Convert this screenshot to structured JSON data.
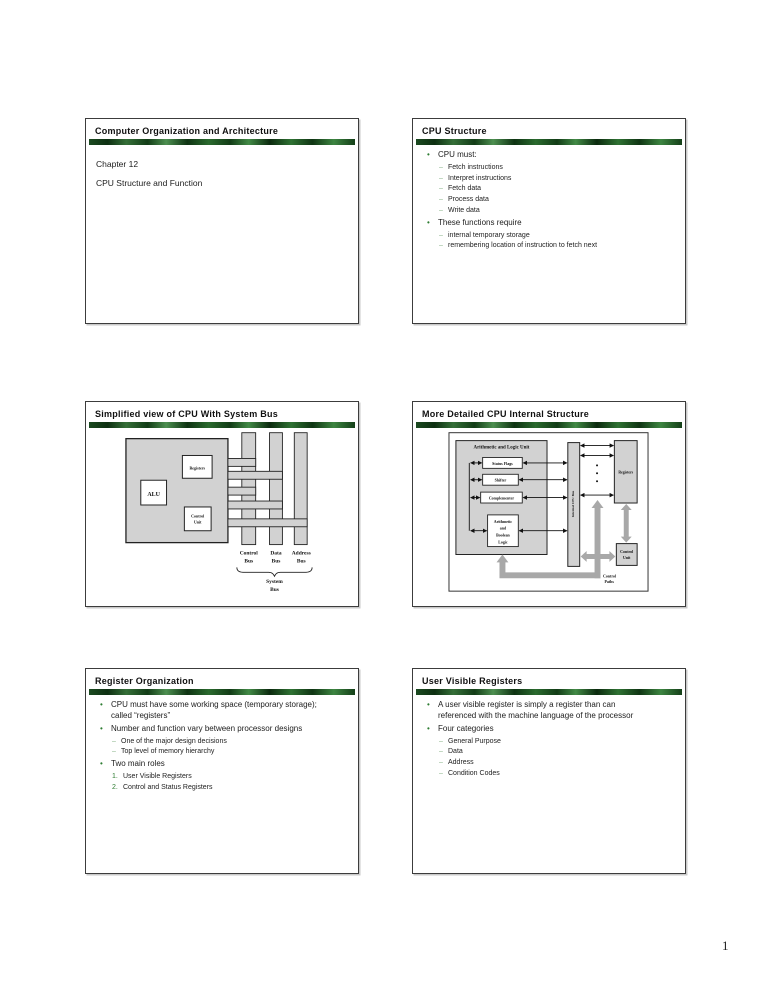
{
  "page_number": "1",
  "slides": [
    {
      "title": "Computer Organization and Architecture",
      "lines": [
        "Chapter 12",
        "CPU Structure and Function"
      ]
    },
    {
      "title": "CPU Structure",
      "items": [
        {
          "marker": "•",
          "text": "CPU must:"
        },
        {
          "marker": "–",
          "text": "Fetch instructions"
        },
        {
          "marker": "–",
          "text": "Interpret instructions"
        },
        {
          "marker": "–",
          "text": "Fetch data"
        },
        {
          "marker": "–",
          "text": "Process data"
        },
        {
          "marker": "–",
          "text": "Write data"
        },
        {
          "marker": "•",
          "text": "These functions require"
        },
        {
          "marker": "–",
          "text": "internal temporary storage"
        },
        {
          "marker": "–",
          "text": "remembering location of instruction to fetch next"
        }
      ]
    },
    {
      "title": "Simplified view of CPU With System Bus",
      "diagram": {
        "alu": "ALU",
        "registers": "Registers",
        "control_unit": [
          "Control",
          "Unit"
        ],
        "bus_columns": [
          "Control",
          "Data",
          "Address"
        ],
        "bus_word": "Bus",
        "system": [
          "System",
          "Bus"
        ]
      }
    },
    {
      "title": "More Detailed CPU Internal Structure",
      "diagram": {
        "alu_title": "Arithmetic and Logic Unit",
        "status_flags": "Status Flags",
        "shifter": "Shifter",
        "complementer": "Complementer",
        "arith_logic": [
          "Arithmetic",
          "and",
          "Boolean",
          "Logic"
        ],
        "internal_bus": "Internal CPU Bus",
        "registers": "Registers",
        "control_unit": [
          "Control",
          "Unit"
        ],
        "control_paths": [
          "Control",
          "Paths"
        ]
      }
    },
    {
      "title": "Register Organization",
      "items": [
        {
          "marker": "•",
          "text": "CPU must have some working space (temporary storage); called “registers”"
        },
        {
          "marker": "•",
          "text": "Number and function vary between processor designs"
        },
        {
          "marker": "–",
          "text": "One of the major design decisions"
        },
        {
          "marker": "–",
          "text": "Top level of memory hierarchy"
        },
        {
          "marker": "•",
          "text": "Two main roles"
        },
        {
          "marker": "1.",
          "text": "User Visible Registers"
        },
        {
          "marker": "2.",
          "text": "Control and Status Registers"
        }
      ]
    },
    {
      "title": "User Visible Registers",
      "items": [
        {
          "marker": "•",
          "text": "A user visible register is simply a register than can referenced with the machine language of the processor"
        },
        {
          "marker": "•",
          "text": "Four categories"
        },
        {
          "marker": "–",
          "text": "General Purpose"
        },
        {
          "marker": "–",
          "text": "Data"
        },
        {
          "marker": "–",
          "text": "Address"
        },
        {
          "marker": "–",
          "text": "Condition Codes"
        }
      ]
    }
  ]
}
